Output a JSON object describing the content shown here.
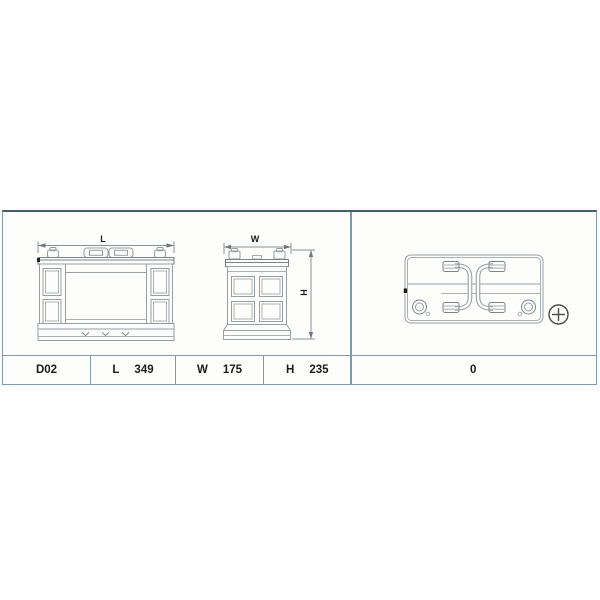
{
  "drawing": {
    "front_view": {
      "dim_label": "L"
    },
    "side_view": {
      "width_label": "W",
      "height_label": "H"
    },
    "top_view": {
      "polarity_icon": "plus-circle",
      "terminals": [
        "negative-terminal",
        "positive-terminal"
      ]
    }
  },
  "spec_table": {
    "type_code": "D02",
    "length": {
      "label": "L",
      "value": "349"
    },
    "width": {
      "label": "W",
      "value": "175"
    },
    "height": {
      "label": "H",
      "value": "235"
    },
    "terminal_layout": "0"
  },
  "colors": {
    "panel_border": "#7e99a9",
    "panel_border_top": "#44606e",
    "drawing_stroke": "#989fa4",
    "text": "#1c1c1c"
  }
}
